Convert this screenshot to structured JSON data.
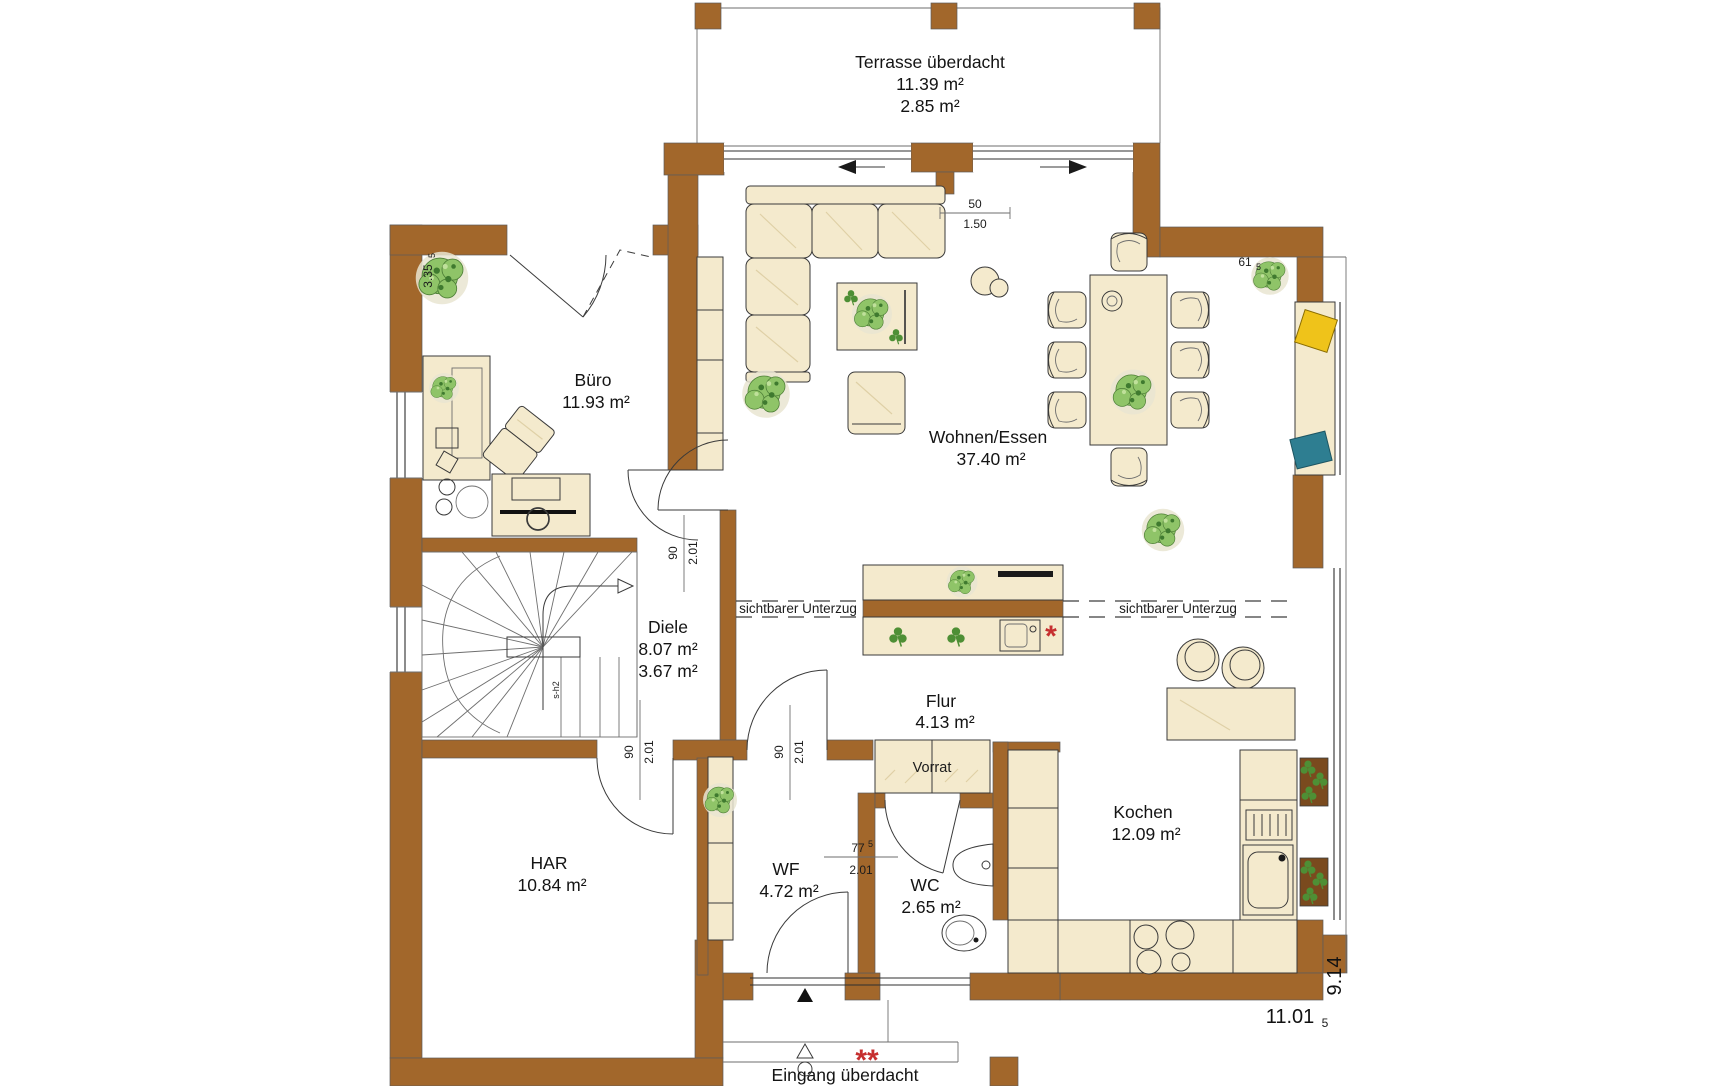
{
  "rooms": {
    "terrasse": {
      "name": "Terrasse überdacht",
      "area": "11.39 m²",
      "area2": "2.85 m²"
    },
    "buero": {
      "name": "Büro",
      "area": "11.93 m²"
    },
    "wohnen_essen": {
      "name": "Wohnen/Essen",
      "area": "37.40 m²"
    },
    "diele": {
      "name": "Diele",
      "area": "8.07 m²",
      "area2": "3.67 m²"
    },
    "flur": {
      "name": "Flur",
      "area": "4.13 m²"
    },
    "vorrat": {
      "name": "Vorrat"
    },
    "har": {
      "name": "HAR",
      "area": "10.84 m²"
    },
    "wf": {
      "name": "WF",
      "area": "4.72 m²"
    },
    "wc": {
      "name": "WC",
      "area": "2.65 m²"
    },
    "kochen": {
      "name": "Kochen",
      "area": "12.09 m²"
    },
    "eingang": {
      "name": "Eingang überdacht"
    }
  },
  "beams": {
    "left": "sichtbarer Unterzug",
    "right": "sichtbarer Unterzug"
  },
  "dimensions": {
    "building_width": "11.01",
    "building_width_sub": "5",
    "building_depth": "9.14",
    "buero_wall": "3.35",
    "buero_wall_sub": "5",
    "dining_offset": "61",
    "dining_offset_sub": "5",
    "sofa_gap": "50",
    "sofa_gap_len": "1.50",
    "door_diele_width": "90",
    "door_diele_height": "2.01",
    "door_har_width": "90",
    "door_har_height": "2.01",
    "door_wf_width": "90",
    "door_wf_height": "2.01",
    "door_wc_width": "77",
    "door_wc_width_sub": "5",
    "door_wc_height": "2.01",
    "stair_label": "s-h2"
  },
  "notes": {
    "island_mark": "*",
    "entrance_mark": "**"
  },
  "colors": {
    "wall": "#A2672B",
    "furniture": "#F4EACD",
    "furniture_dark": "#EADCB4",
    "plant": "#8FC468",
    "plant_dark": "#3F7A2F",
    "accent_yellow": "#EFC31A",
    "accent_teal": "#2E7E91",
    "accent_red": "#C62F2F",
    "wood": "#7A4A1E",
    "line": "#3A3A3A"
  }
}
